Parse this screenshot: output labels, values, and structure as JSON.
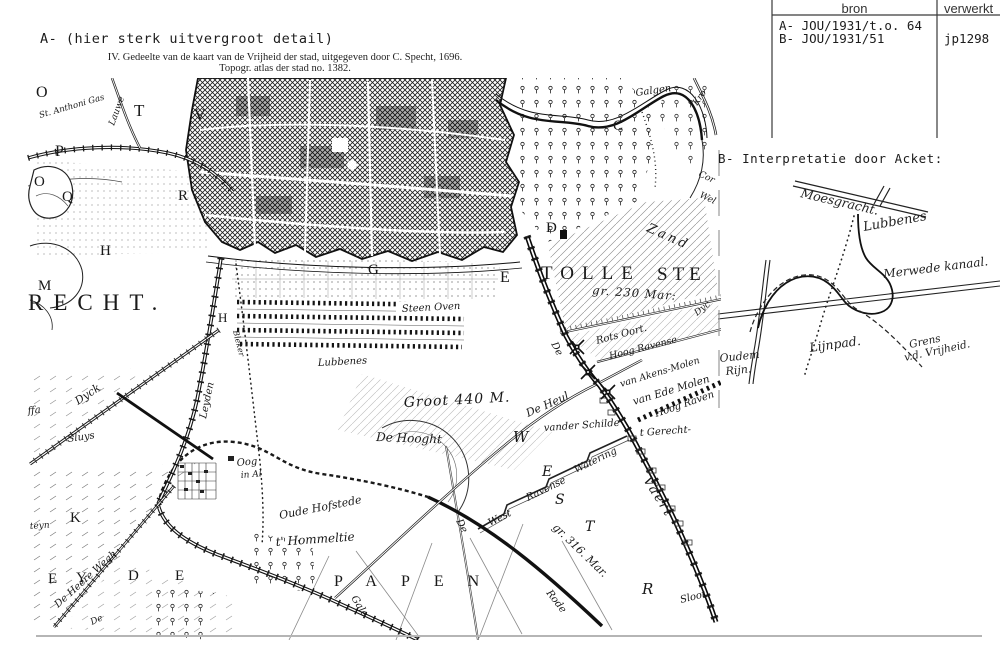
{
  "header_table": {
    "col1": "bron",
    "col2": "verwerkt",
    "source_a": "A- JOU/1931/t.o. 64",
    "source_b": "B- JOU/1931/51",
    "processed": "jp1298"
  },
  "annotations": {
    "label_a": "A- (hier sterk uitvergroot detail)",
    "caption_line1": "IV. Gedeelte van de kaart van de Vrijheid der stad, uitgegeven door C. Specht, 1696.",
    "caption_line2": "Topogr. atlas der stad no. 1382.",
    "label_b": "B- Interpretatie door Acket:"
  },
  "map": {
    "labels": [
      {
        "t": "O",
        "x": 36,
        "y": 97,
        "s": 16,
        "c": "big"
      },
      {
        "t": "T",
        "x": 134,
        "y": 116,
        "s": 17,
        "c": "big"
      },
      {
        "t": "V",
        "x": 194,
        "y": 120,
        "s": 16,
        "c": "big"
      },
      {
        "t": "P",
        "x": 55,
        "y": 156,
        "s": 16,
        "c": "big"
      },
      {
        "t": "O",
        "x": 34,
        "y": 186,
        "s": 15,
        "c": "big"
      },
      {
        "t": "Q",
        "x": 62,
        "y": 201,
        "s": 15,
        "c": "big"
      },
      {
        "t": "R",
        "x": 178,
        "y": 200,
        "s": 15,
        "c": "big"
      },
      {
        "t": "H",
        "x": 100,
        "y": 255,
        "s": 15,
        "c": "big"
      },
      {
        "t": "M",
        "x": 38,
        "y": 290,
        "s": 15,
        "c": "big"
      },
      {
        "t": "H",
        "x": 218,
        "y": 322,
        "s": 13,
        "c": "big"
      },
      {
        "t": "C",
        "x": 613,
        "y": 130,
        "s": 15,
        "c": "big"
      },
      {
        "t": "D",
        "x": 546,
        "y": 232,
        "s": 15,
        "c": "big"
      },
      {
        "t": "G",
        "x": 368,
        "y": 274,
        "s": 15,
        "c": "big"
      },
      {
        "t": "E",
        "x": 500,
        "y": 282,
        "s": 16,
        "c": "big"
      },
      {
        "t": "K",
        "x": 70,
        "y": 522,
        "s": 15,
        "c": "big"
      },
      {
        "t": "RECHT.",
        "x": 28,
        "y": 310,
        "s": 23,
        "ls": 10,
        "c": "big"
      },
      {
        "t": "TOLLE",
        "x": 541,
        "y": 279,
        "s": 19,
        "ls": 8,
        "c": "big"
      },
      {
        "t": "STE",
        "x": 657,
        "y": 280,
        "s": 19,
        "ls": 5,
        "c": "big"
      },
      {
        "t": "PAPEN",
        "x": 334,
        "y": 586,
        "s": 16,
        "ls": 24,
        "c": "big"
      },
      {
        "t": "E",
        "x": 48,
        "y": 583,
        "s": 15,
        "c": "big"
      },
      {
        "t": "Y",
        "x": 76,
        "y": 582,
        "s": 15,
        "c": "big"
      },
      {
        "t": "D",
        "x": 128,
        "y": 580,
        "s": 15,
        "c": "big"
      },
      {
        "t": "E",
        "x": 175,
        "y": 580,
        "s": 15,
        "c": "big"
      },
      {
        "t": "W",
        "x": 513,
        "y": 442,
        "s": 15,
        "c": "scr"
      },
      {
        "t": "E",
        "x": 542,
        "y": 476,
        "s": 14,
        "c": "scr"
      },
      {
        "t": "S",
        "x": 555,
        "y": 504,
        "s": 14,
        "c": "scr"
      },
      {
        "t": "T",
        "x": 585,
        "y": 531,
        "s": 14,
        "c": "scr"
      },
      {
        "t": "R",
        "x": 642,
        "y": 594,
        "s": 15,
        "c": "scr"
      },
      {
        "t": "St. Anthoni Gas",
        "x": 40,
        "y": 118,
        "r": -16,
        "s": 8.5,
        "c": "scr"
      },
      {
        "t": "Lauwe",
        "x": 114,
        "y": 126,
        "r": -70,
        "s": 9,
        "c": "scr"
      },
      {
        "t": "Galgen",
        "x": 636,
        "y": 96,
        "r": -8,
        "s": 10,
        "c": "scr"
      },
      {
        "t": "Kro",
        "x": 697,
        "y": 106,
        "r": -55,
        "s": 9,
        "c": "scr"
      },
      {
        "t": "Cor",
        "x": 698,
        "y": 176,
        "r": 25,
        "s": 9,
        "c": "scr"
      },
      {
        "t": "Wel",
        "x": 699,
        "y": 197,
        "r": 25,
        "s": 9,
        "c": "scr"
      },
      {
        "t": "Zand",
        "x": 646,
        "y": 231,
        "r": 24,
        "s": 13,
        "ls": 3,
        "c": "scr"
      },
      {
        "t": "gr. 230 Mar:",
        "x": 592,
        "y": 294,
        "r": 4,
        "s": 11.5,
        "ls": 1,
        "c": "scr"
      },
      {
        "t": "Steen Oven",
        "x": 402,
        "y": 312,
        "r": -3,
        "s": 10,
        "c": "scr"
      },
      {
        "t": "Lubbenes",
        "x": 318,
        "y": 366,
        "r": -3,
        "s": 10,
        "c": "scr"
      },
      {
        "t": "Groot 440 M.",
        "x": 404,
        "y": 407,
        "r": -3,
        "s": 14,
        "ls": 1,
        "c": "scr"
      },
      {
        "t": "De Hooght",
        "x": 376,
        "y": 441,
        "r": 2,
        "s": 12,
        "c": "scr"
      },
      {
        "t": "De",
        "x": 551,
        "y": 344,
        "r": 62,
        "s": 10,
        "c": "scr"
      },
      {
        "t": "De Heul",
        "x": 528,
        "y": 417,
        "r": -24,
        "s": 11,
        "c": "scr"
      },
      {
        "t": "Rots Oort.",
        "x": 597,
        "y": 344,
        "r": -15,
        "s": 10,
        "c": "scr"
      },
      {
        "t": "Hoog Ravense",
        "x": 610,
        "y": 359,
        "r": -14,
        "s": 9.5,
        "c": "scr"
      },
      {
        "t": "Dyc",
        "x": 697,
        "y": 316,
        "r": -38,
        "s": 9,
        "c": "scr"
      },
      {
        "t": "van Akens-Molen",
        "x": 621,
        "y": 387,
        "r": -17,
        "s": 9.5,
        "c": "scr"
      },
      {
        "t": "van Ede Molen",
        "x": 634,
        "y": 405,
        "r": -17,
        "s": 10.5,
        "c": "scr"
      },
      {
        "t": "Hoog Raven",
        "x": 656,
        "y": 417,
        "r": -19,
        "s": 10,
        "c": "scr"
      },
      {
        "t": "vander Schilde",
        "x": 544,
        "y": 431,
        "r": -4,
        "s": 10,
        "c": "scr"
      },
      {
        "t": "t Gerecht-",
        "x": 640,
        "y": 436,
        "r": -4,
        "s": 10,
        "c": "scr"
      },
      {
        "t": "West",
        "x": 490,
        "y": 526,
        "r": -26,
        "s": 10,
        "c": "scr"
      },
      {
        "t": "Ravense",
        "x": 528,
        "y": 501,
        "r": -26,
        "s": 10,
        "c": "scr"
      },
      {
        "t": "Watering",
        "x": 576,
        "y": 473,
        "r": -26,
        "s": 10,
        "c": "scr"
      },
      {
        "t": "gr. 316. Mar.",
        "x": 552,
        "y": 528,
        "r": 44,
        "s": 11,
        "c": "scr"
      },
      {
        "t": "Vaert",
        "x": 643,
        "y": 480,
        "r": 58,
        "s": 13,
        "ls": 2,
        "c": "scr"
      },
      {
        "t": "De",
        "x": 456,
        "y": 521,
        "r": 63,
        "s": 10,
        "c": "scr"
      },
      {
        "t": "Rode",
        "x": 546,
        "y": 593,
        "r": 52,
        "s": 10,
        "c": "scr"
      },
      {
        "t": "Sloot.",
        "x": 681,
        "y": 603,
        "r": -14,
        "s": 10,
        "c": "scr"
      },
      {
        "t": "Gale",
        "x": 351,
        "y": 598,
        "r": 58,
        "s": 10,
        "c": "scr"
      },
      {
        "t": "Oude Hofstede",
        "x": 280,
        "y": 519,
        "r": -11,
        "s": 11,
        "c": "scr"
      },
      {
        "t": "t' Hommeltie",
        "x": 276,
        "y": 546,
        "r": -4,
        "s": 12,
        "c": "scr"
      },
      {
        "t": "Oog",
        "x": 237,
        "y": 466,
        "r": -5,
        "s": 10,
        "c": "scr"
      },
      {
        "t": "in Al",
        "x": 241,
        "y": 478,
        "r": -5,
        "s": 9,
        "c": "scr"
      },
      {
        "t": "Leyden",
        "x": 206,
        "y": 419,
        "r": -78,
        "s": 10,
        "c": "scr"
      },
      {
        "t": "Dyck",
        "x": 78,
        "y": 405,
        "r": -34,
        "s": 11,
        "c": "scr"
      },
      {
        "t": "Sluys",
        "x": 68,
        "y": 442,
        "r": -8,
        "s": 10,
        "c": "scr"
      },
      {
        "t": "ffa",
        "x": 28,
        "y": 414,
        "r": -6,
        "s": 10,
        "c": "scr"
      },
      {
        "t": "teyn",
        "x": 30,
        "y": 529,
        "r": -4,
        "s": 9,
        "c": "scr"
      },
      {
        "t": "De Heere Wegh",
        "x": 58,
        "y": 608,
        "r": -42,
        "s": 10,
        "c": "scr"
      },
      {
        "t": "De",
        "x": 92,
        "y": 625,
        "r": -25,
        "s": 9,
        "c": "scr"
      },
      {
        "t": "Bleker",
        "x": 233,
        "y": 331,
        "r": 76,
        "s": 8,
        "c": "scr"
      }
    ]
  },
  "sketch": {
    "labels": [
      {
        "t": "Moesgracht.",
        "x": 800,
        "y": 197,
        "r": 13,
        "s": 12.5,
        "c": "hand"
      },
      {
        "t": "Lubbenes",
        "x": 864,
        "y": 231,
        "r": -10,
        "s": 13,
        "c": "hand"
      },
      {
        "t": "Merwede kanaal.",
        "x": 884,
        "y": 278,
        "r": -7,
        "s": 12,
        "c": "hand"
      },
      {
        "t": "Lijnpad.",
        "x": 810,
        "y": 352,
        "r": -8,
        "s": 12.5,
        "c": "hand"
      },
      {
        "t": "Oudem",
        "x": 720,
        "y": 362,
        "r": -6,
        "s": 11,
        "c": "hand"
      },
      {
        "t": "Rijn.",
        "x": 726,
        "y": 375,
        "r": -6,
        "s": 11,
        "c": "hand"
      },
      {
        "t": "Grens",
        "x": 910,
        "y": 348,
        "r": -12,
        "s": 10.5,
        "c": "hand"
      },
      {
        "t": "v.d. Vrijheid.",
        "x": 905,
        "y": 361,
        "r": -12,
        "s": 10.5,
        "c": "hand"
      }
    ]
  }
}
